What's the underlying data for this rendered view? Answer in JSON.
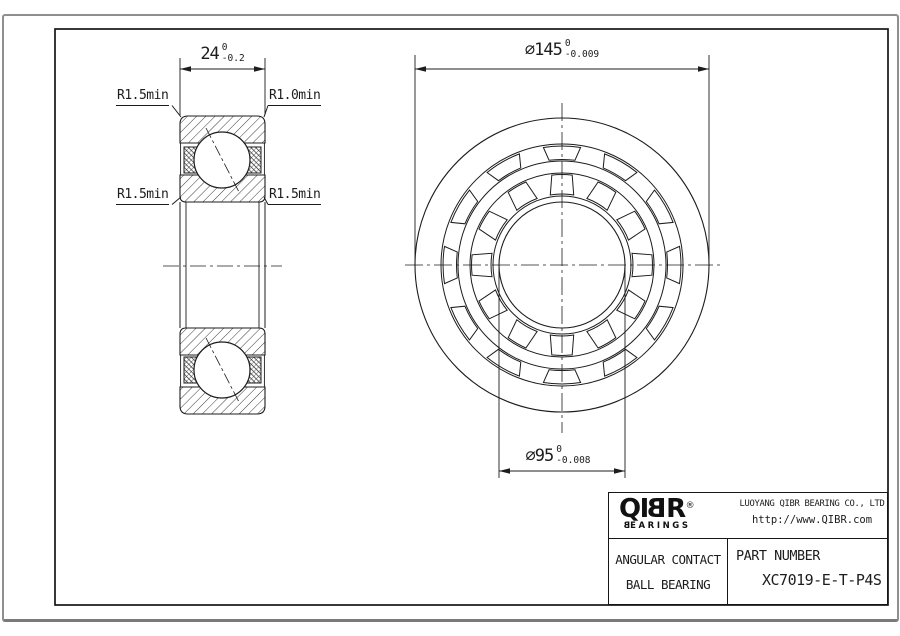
{
  "section_view": {
    "width_dim": {
      "value": "24",
      "tol_upper": "0",
      "tol_lower": "-0.2"
    },
    "radius_labels": {
      "top_left": "R1.5min",
      "top_right": "R1.0min",
      "mid_left": "R1.5min",
      "mid_right": "R1.5min"
    }
  },
  "front_view": {
    "outer_dia_dim": {
      "value": "⌀145",
      "tol_upper": "0",
      "tol_lower": "-0.009"
    },
    "bore_dia_dim": {
      "value": "⌀95",
      "tol_upper": "0",
      "tol_lower": "-0.008"
    }
  },
  "title_block": {
    "logo": {
      "brand_prefix": "QI",
      "brand_mirrored_b": "B",
      "brand_suffix": "R",
      "registered_mark": "®",
      "sub_mirrored_b": "B",
      "sub_rest": "EARINGS"
    },
    "company_name": "LUOYANG QIBR BEARING CO., LTD",
    "website": "http://www.QIBR.com",
    "product_type_line1": "ANGULAR CONTACT",
    "product_type_line2": "BALL BEARING",
    "part_number_label": "PART NUMBER",
    "part_number": "XC7019-E-T-P4S"
  }
}
